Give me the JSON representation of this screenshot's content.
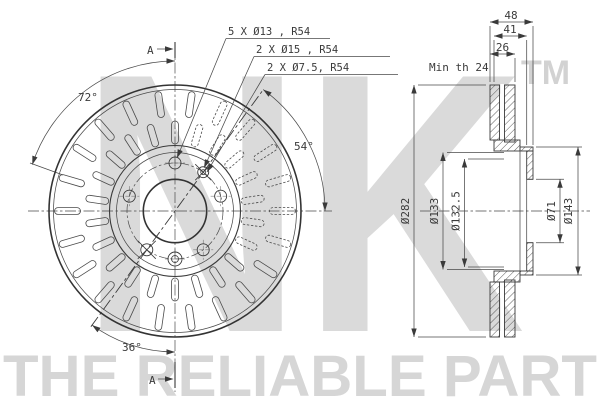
{
  "watermark": {
    "logo_text": "NK",
    "trademark": "TM",
    "tagline": "THE RELIABLE PART"
  },
  "front_view": {
    "section_label_top": "A",
    "section_label_bottom": "A",
    "callouts": [
      {
        "label": "5 X Ø13 , R54"
      },
      {
        "label": "2 X Ø15 , R54"
      },
      {
        "label": "2 X Ø7.5, R54"
      }
    ],
    "angle_labels": {
      "upper_left": "72°",
      "right": "54°",
      "lower_left": "36°"
    }
  },
  "section_view": {
    "width_dims": {
      "overall": "48",
      "hat": "41",
      "disc": "26"
    },
    "note_min_thickness": "Min th 24",
    "diameter_dims": {
      "outer": "Ø282",
      "hat_outer": "Ø133",
      "hat_inner": "Ø132.5",
      "bore": "Ø71",
      "pilot": "Ø143"
    }
  }
}
